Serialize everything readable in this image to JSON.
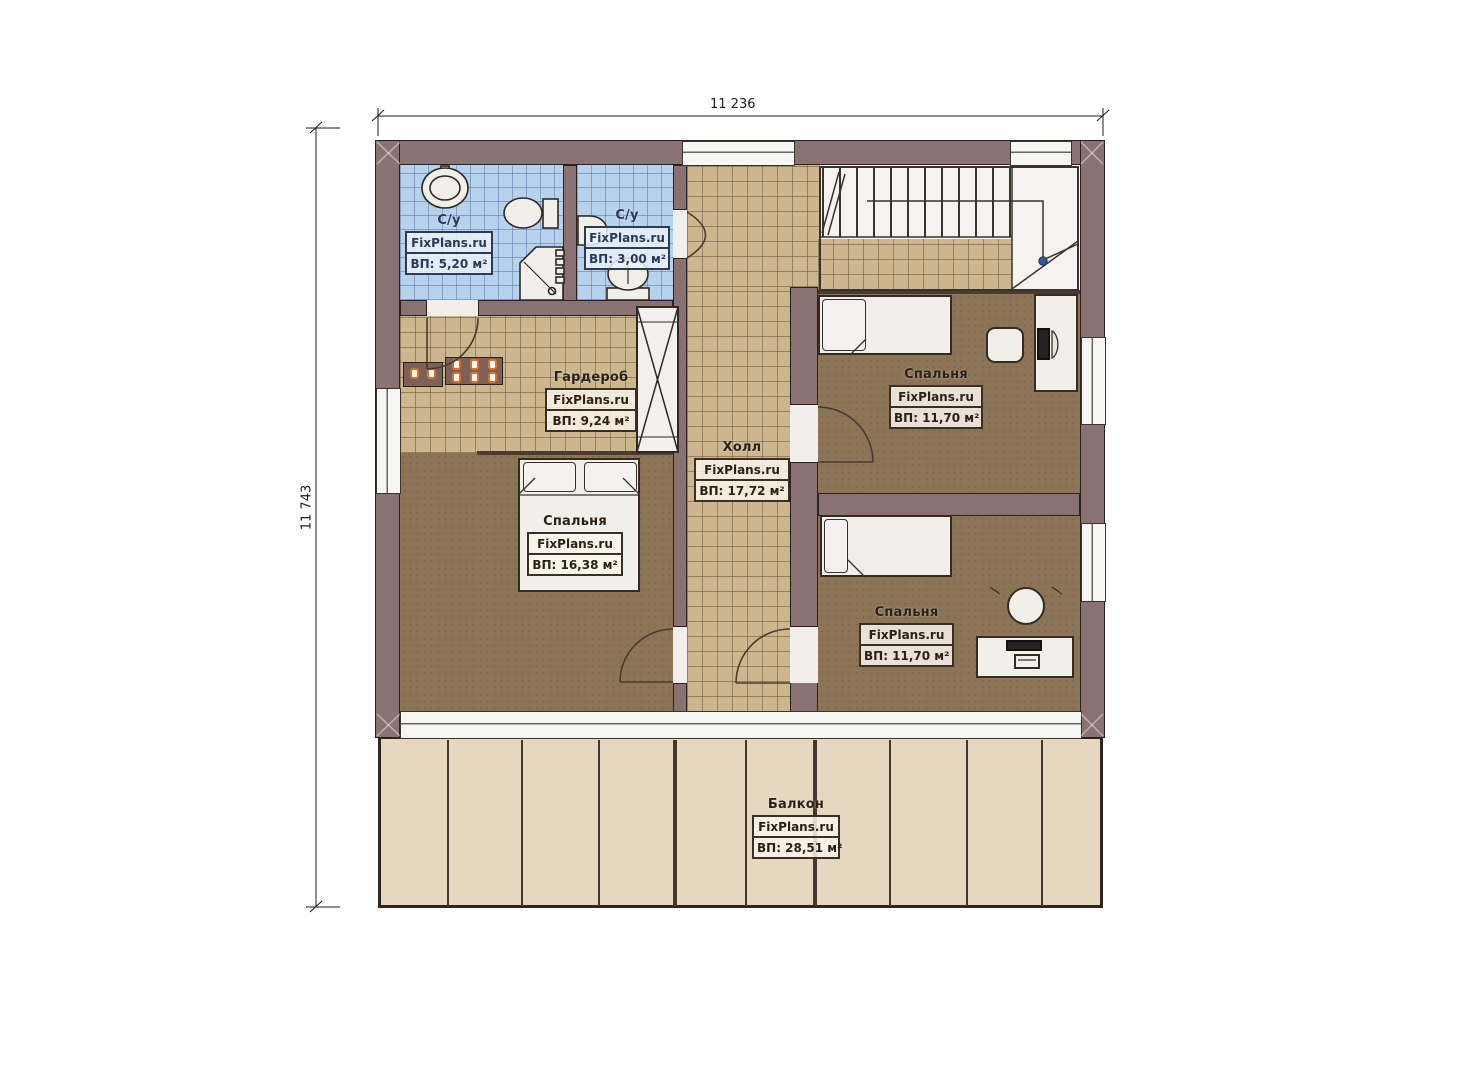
{
  "plan": {
    "title": "floor-plan-second-floor",
    "brand": "FixPlans.ru",
    "dimensions": {
      "width_label": "11 236",
      "height_label": "11 743"
    },
    "colors": {
      "wall": "#8a7272",
      "tile_tan": "#ccb68e",
      "tile_blue": "#b7d2ec",
      "carpet": "#8c7456",
      "balcony": "#e6d8c0",
      "outline": "#2b2220",
      "knob_orange": "#dd7126",
      "stair_node_blue": "#3a5a8c"
    },
    "rooms": [
      {
        "id": "bathroom-1",
        "name": "С/у",
        "site": "FixPlans.ru",
        "area": "ВП: 5,20 м²"
      },
      {
        "id": "bathroom-2",
        "name": "С/у",
        "site": "FixPlans.ru",
        "area": "ВП: 3,00 м²"
      },
      {
        "id": "wardrobe",
        "name": "Гардероб",
        "site": "FixPlans.ru",
        "area": "ВП: 9,24 м²"
      },
      {
        "id": "hall",
        "name": "Холл",
        "site": "FixPlans.ru",
        "area": "ВП: 17,72 м²"
      },
      {
        "id": "bedroom-master",
        "name": "Спальня",
        "site": "FixPlans.ru",
        "area": "ВП: 16,38 м²"
      },
      {
        "id": "bedroom-top-right",
        "name": "Спальня",
        "site": "FixPlans.ru",
        "area": "ВП: 11,70 м²"
      },
      {
        "id": "bedroom-bottom-right",
        "name": "Спальня",
        "site": "FixPlans.ru",
        "area": "ВП: 11,70 м²"
      },
      {
        "id": "balcony",
        "name": "Балкон",
        "site": "FixPlans.ru",
        "area": "ВП: 28,51 м²"
      }
    ]
  }
}
